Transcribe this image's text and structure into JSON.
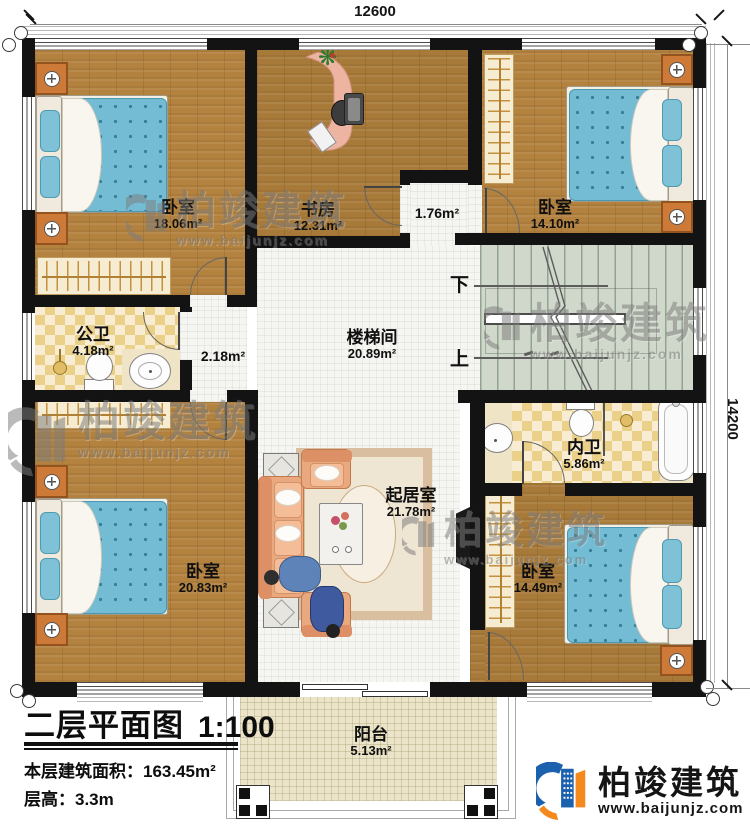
{
  "plan": {
    "dim_top": "12600",
    "dim_right": "14200",
    "stair_down": "下",
    "stair_up": "上"
  },
  "rooms": {
    "bedroom_tl": {
      "name": "卧室",
      "area": "18.06m²"
    },
    "study": {
      "name": "书房",
      "area": "12.31m²"
    },
    "hall_small": {
      "area": "1.76m²"
    },
    "bedroom_tr": {
      "name": "卧室",
      "area": "14.10m²"
    },
    "public_bath": {
      "name": "公卫",
      "area": "4.18m²"
    },
    "hall_mid": {
      "area": "2.18m²"
    },
    "stairwell": {
      "name": "楼梯间",
      "area": "20.89m²"
    },
    "inner_bath": {
      "name": "内卫",
      "area": "5.86m²"
    },
    "bedroom_bl": {
      "name": "卧室",
      "area": "20.83m²"
    },
    "living_room": {
      "name": "起居室",
      "area": "21.78m²"
    },
    "bedroom_br": {
      "name": "卧室",
      "area": "14.49m²"
    },
    "balcony": {
      "name": "阳台",
      "area": "5.13m²"
    }
  },
  "title_block": {
    "title": "二层平面图",
    "scale": "1:100",
    "floor_area_label": "本层建筑面积：",
    "floor_area_value": "163.45m²",
    "floor_height_label": "层高：",
    "floor_height_value": "3.3m"
  },
  "watermark": {
    "brand": "柏竣建筑",
    "url": "www.baijunjz.com"
  },
  "logo": {
    "brand": "柏竣建筑",
    "url": "www.baijunjz.com"
  },
  "icons": {
    "plant": "❋"
  },
  "colors": {
    "logo_blue": "#1b61ae",
    "logo_orange": "#f5891d",
    "wall": "#131313",
    "wood": "#b3823f",
    "mattress_blue": "#74bcd4",
    "stairs_green": "#cfd8ca"
  }
}
